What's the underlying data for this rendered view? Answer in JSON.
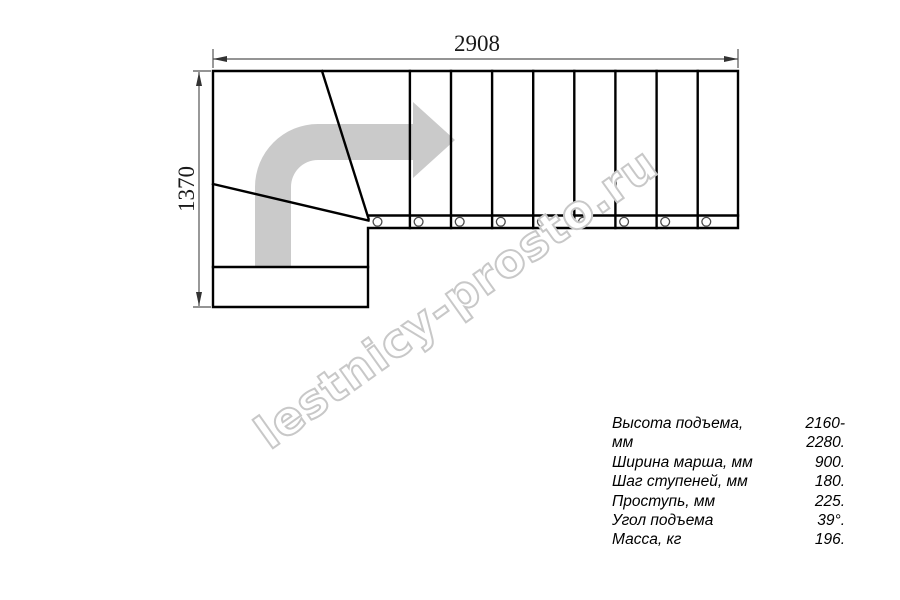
{
  "drawing": {
    "type": "staircase-plan-top-view",
    "width_dimension": "2908",
    "height_dimension": "1370",
    "watermark": "lestnicy-prosto.ru",
    "straight_flight_steps": 9,
    "colors": {
      "outline": "#000000",
      "direction_arrow": "#cacaca",
      "watermark_stroke": "#c8c8c8",
      "dimension_lines": "#555555",
      "background": "#ffffff"
    }
  },
  "specs": {
    "rows": [
      {
        "label": "Высота подъема, мм",
        "value": "2160-2280."
      },
      {
        "label": "Ширина марша, мм",
        "value": "900."
      },
      {
        "label": "Шаг ступеней, мм",
        "value": "180."
      },
      {
        "label": "Проступь, мм",
        "value": "225."
      },
      {
        "label": "Угол подъема",
        "value": "39°."
      },
      {
        "label": "Масса, кг",
        "value": "196."
      }
    ]
  }
}
